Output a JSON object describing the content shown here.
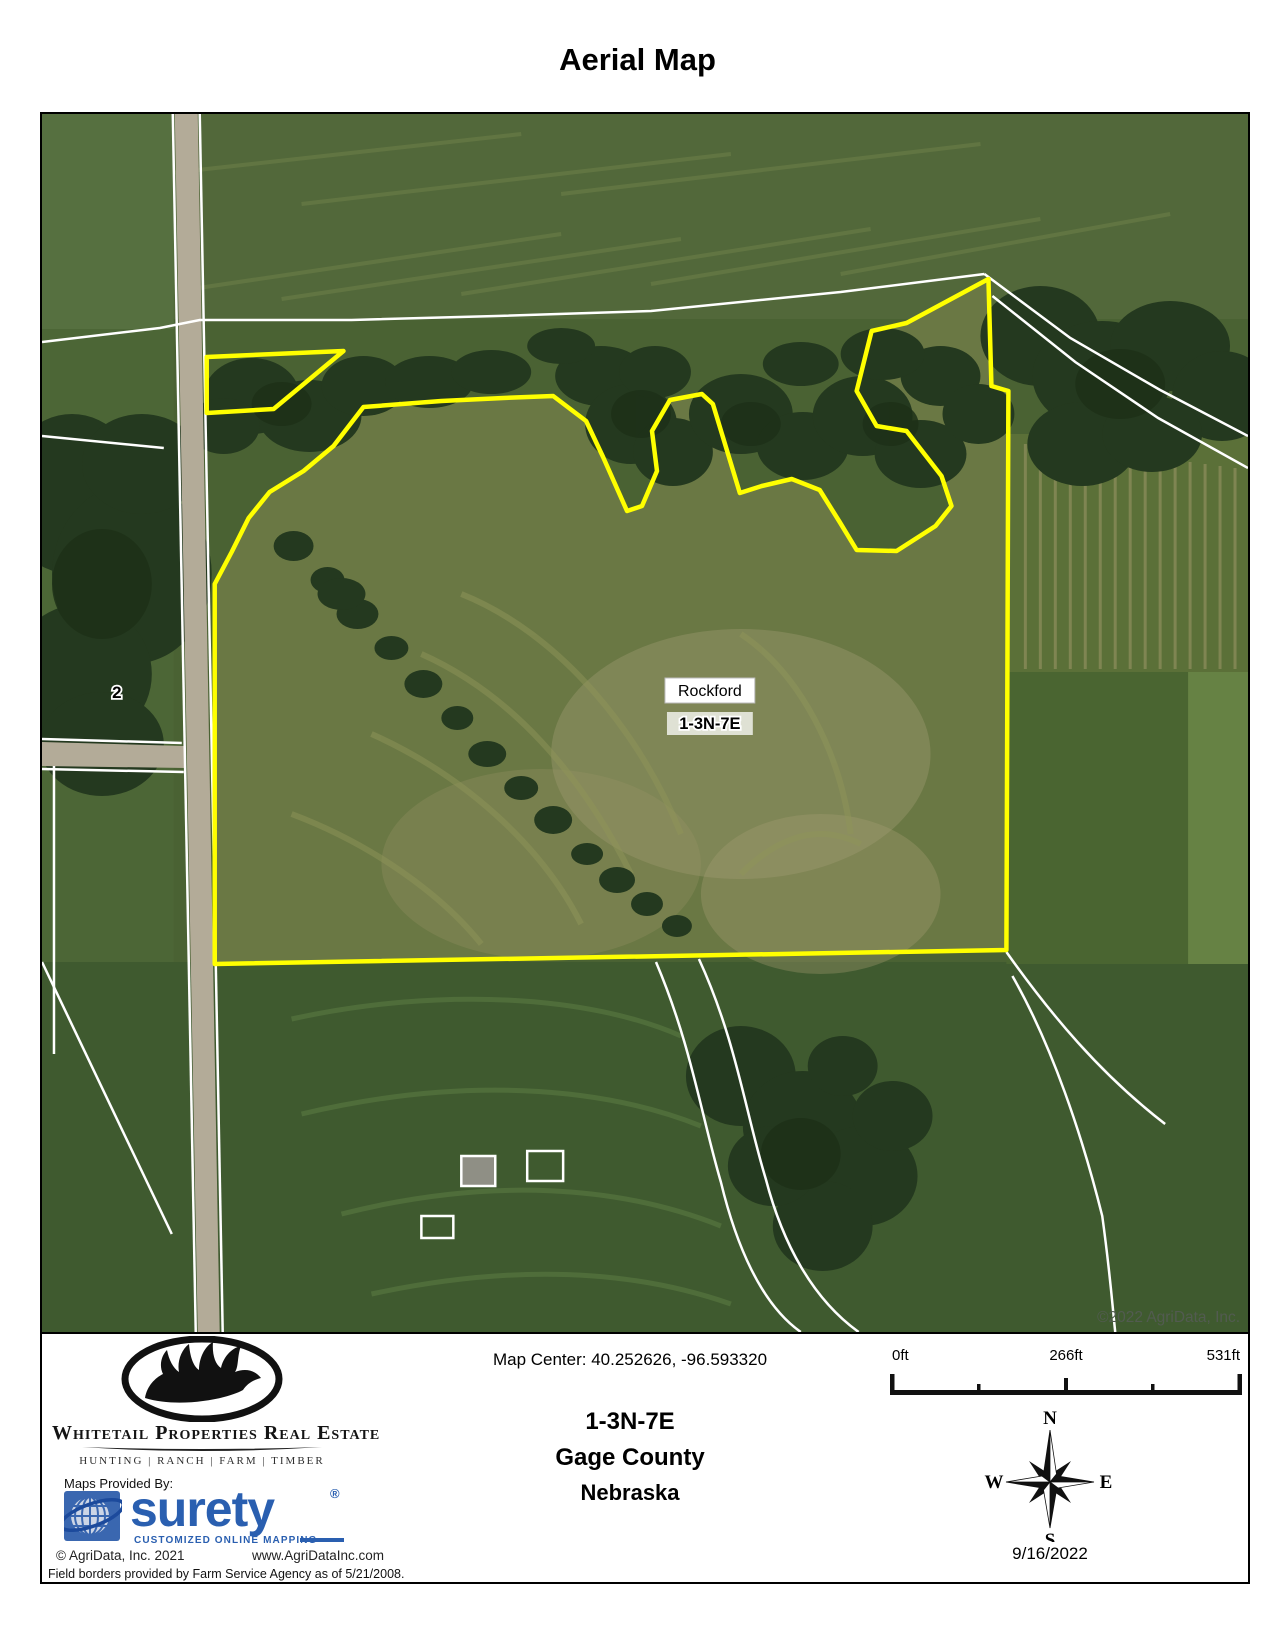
{
  "title": "Aerial Map",
  "map": {
    "labels": {
      "place": "Rockford",
      "township": "1-3N-7E",
      "parcel_number": "2"
    },
    "copyright": "©2022 AgriData, Inc.",
    "colors": {
      "boundary": "#ffff00",
      "field_border": "#ffffff"
    }
  },
  "footer": {
    "brand": {
      "name": "Whitetail Properties Real Estate",
      "tagline": "HUNTING | RANCH | FARM | TIMBER",
      "maps_provided_by": "Maps Provided By:",
      "surety_name": "surety",
      "surety_registered": "®",
      "surety_tagline": "CUSTOMIZED ONLINE MAPPING",
      "surety_color": "#2a5fb0",
      "agridata_copyright": "© AgriData, Inc. 2021",
      "agridata_url": "www.AgriDataInc.com"
    },
    "map_center": "Map Center: 40.252626, -96.593320",
    "location": {
      "township": "1-3N-7E",
      "county": "Gage County",
      "state": "Nebraska"
    },
    "scale": {
      "start": "0ft",
      "middle": "266ft",
      "end": "531ft"
    },
    "compass": {
      "north": "N",
      "south": "S",
      "east": "E",
      "west": "W"
    },
    "date": "9/16/2022",
    "disclaimer": "Field borders provided by Farm Service Agency as of 5/21/2008."
  }
}
